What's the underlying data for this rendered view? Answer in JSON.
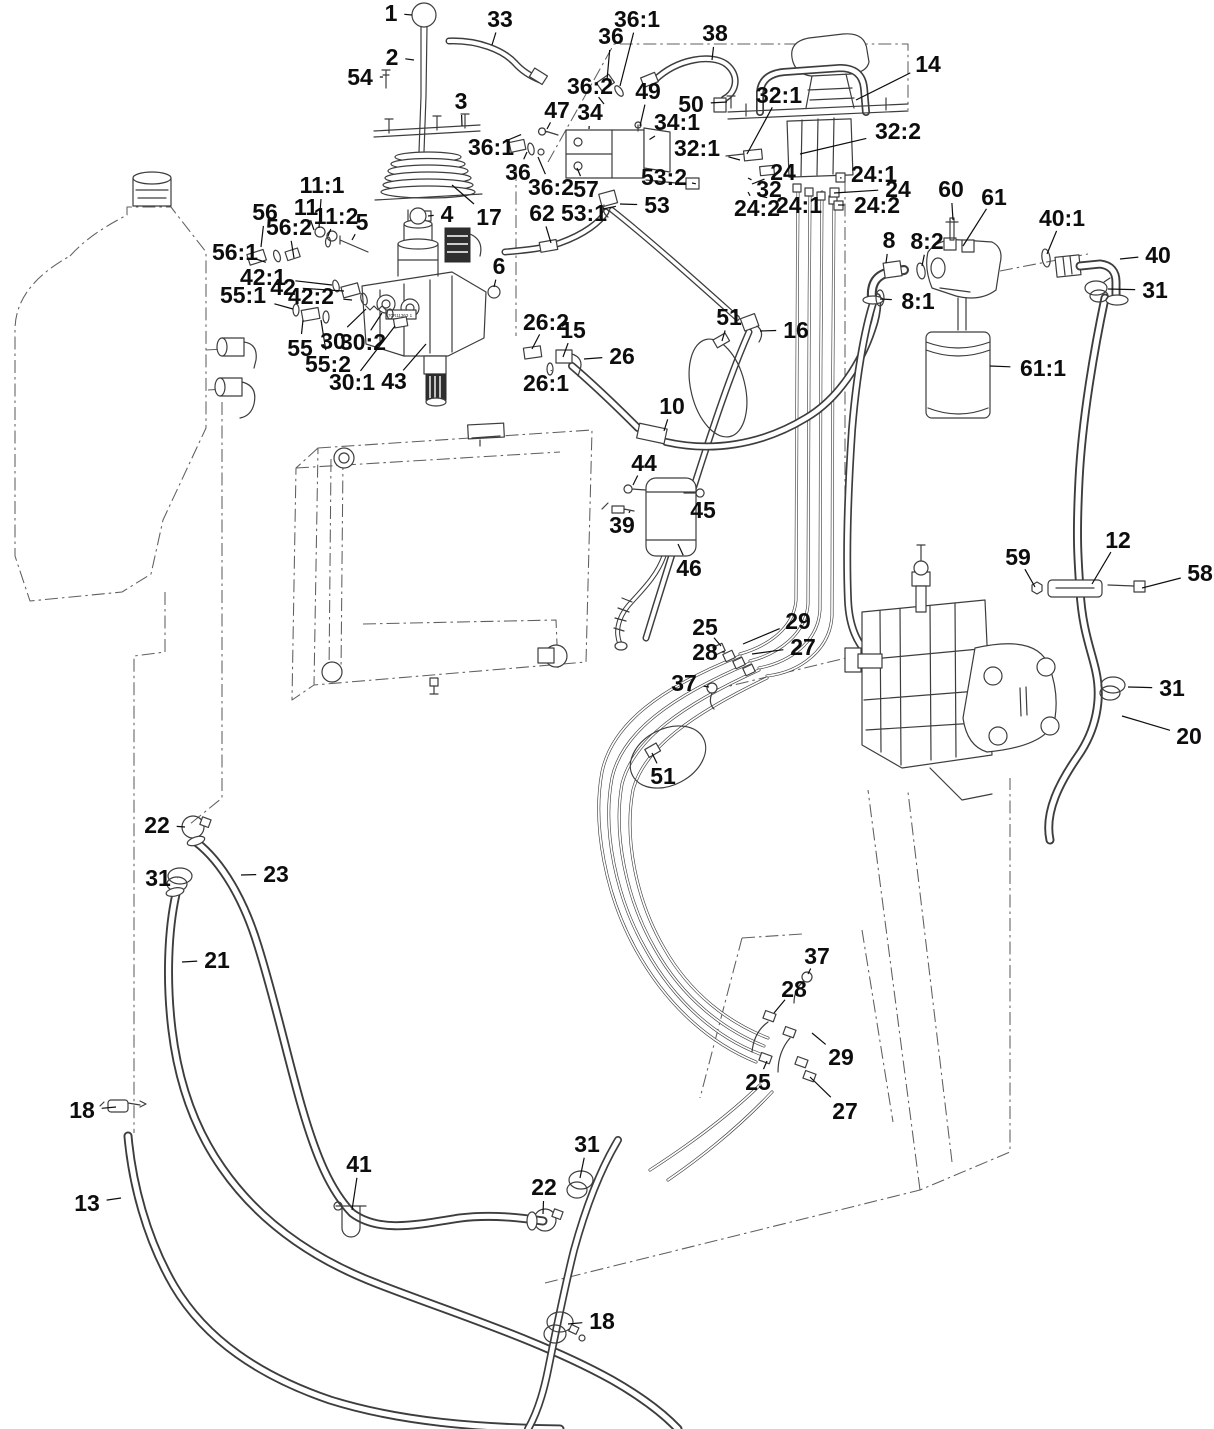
{
  "diagram": {
    "type": "parts-diagram",
    "canvas": {
      "width": 1214,
      "height": 1429
    },
    "colors": {
      "line": "#3d3d3d",
      "label": "#0d0d0d",
      "background": "#ffffff",
      "dash": "#5f5f5f"
    },
    "sticker_text": "70R11363 1",
    "callouts": [
      {
        "id": "1",
        "text": "1",
        "x": 391,
        "y": 13,
        "lx": 412,
        "ly": 15
      },
      {
        "id": "2",
        "text": "2",
        "x": 392,
        "y": 57,
        "lx": 414,
        "ly": 60
      },
      {
        "id": "54",
        "text": "54",
        "x": 360,
        "y": 77,
        "lx": 383,
        "ly": 77
      },
      {
        "id": "33",
        "text": "33",
        "x": 500,
        "y": 19,
        "lx": 492,
        "ly": 45
      },
      {
        "id": "3",
        "text": "3",
        "x": 461,
        "y": 101,
        "lx": 462,
        "ly": 126
      },
      {
        "id": "36-top",
        "text": "36",
        "x": 611,
        "y": 36,
        "lx": 607,
        "ly": 80
      },
      {
        "id": "36-1-top",
        "text": "36:1",
        "x": 637,
        "y": 19,
        "lx": 620,
        "ly": 86
      },
      {
        "id": "38",
        "text": "38",
        "x": 715,
        "y": 33,
        "lx": 712,
        "ly": 60
      },
      {
        "id": "36-2-top",
        "text": "36:2",
        "x": 590,
        "y": 86,
        "lx": 604,
        "ly": 104
      },
      {
        "id": "47",
        "text": "47",
        "x": 557,
        "y": 110,
        "lx": 547,
        "ly": 129
      },
      {
        "id": "34",
        "text": "34",
        "x": 590,
        "y": 112,
        "lx": 589,
        "ly": 129
      },
      {
        "id": "49",
        "text": "49",
        "x": 648,
        "y": 91,
        "lx": 640,
        "ly": 126
      },
      {
        "id": "50",
        "text": "50",
        "x": 691,
        "y": 104,
        "lx": 727,
        "ly": 102
      },
      {
        "id": "34-1",
        "text": "34:1",
        "x": 677,
        "y": 122,
        "lx": 655,
        "ly": 136
      },
      {
        "id": "32-1-top",
        "text": "32:1",
        "x": 779,
        "y": 95,
        "lx": 747,
        "ly": 154
      },
      {
        "id": "32-2",
        "text": "32:2",
        "x": 898,
        "y": 131,
        "lx": 800,
        "ly": 154
      },
      {
        "id": "32-1-mid",
        "text": "32:1",
        "x": 697,
        "y": 148,
        "lx": 740,
        "ly": 160
      },
      {
        "id": "24-l",
        "text": "24",
        "x": 783,
        "y": 172,
        "lx": 752,
        "ly": 184
      },
      {
        "id": "32-l",
        "text": "32",
        "x": 769,
        "y": 189,
        "lx": 748,
        "ly": 178
      },
      {
        "id": "24-2-l",
        "text": "24:2",
        "x": 757,
        "y": 208,
        "lx": 748,
        "ly": 192
      },
      {
        "id": "24-1-l",
        "text": "24:1",
        "x": 799,
        "y": 205,
        "lx": 760,
        "ly": 196
      },
      {
        "id": "24-1-r",
        "text": "24:1",
        "x": 874,
        "y": 174,
        "lx": 840,
        "ly": 178
      },
      {
        "id": "24-r",
        "text": "24",
        "x": 898,
        "y": 189,
        "lx": 834,
        "ly": 193
      },
      {
        "id": "24-2-r",
        "text": "24:2",
        "x": 877,
        "y": 205,
        "lx": 838,
        "ly": 205
      },
      {
        "id": "14",
        "text": "14",
        "x": 928,
        "y": 64,
        "lx": 856,
        "ly": 100
      },
      {
        "id": "53-2",
        "text": "53:2",
        "x": 664,
        "y": 177,
        "lx": 692,
        "ly": 183
      },
      {
        "id": "53",
        "text": "53",
        "x": 657,
        "y": 205,
        "lx": 620,
        "ly": 204
      },
      {
        "id": "53-1",
        "text": "53:1",
        "x": 584,
        "y": 213,
        "lx": 603,
        "ly": 209
      },
      {
        "id": "62",
        "text": "62",
        "x": 542,
        "y": 213,
        "lx": 551,
        "ly": 243
      },
      {
        "id": "57",
        "text": "57",
        "x": 586,
        "y": 189,
        "lx": 577,
        "ly": 168
      },
      {
        "id": "36-2-l",
        "text": "36:2",
        "x": 551,
        "y": 187,
        "lx": 538,
        "ly": 157
      },
      {
        "id": "36-l",
        "text": "36",
        "x": 518,
        "y": 172,
        "lx": 527,
        "ly": 152
      },
      {
        "id": "36-1-l",
        "text": "36:1",
        "x": 491,
        "y": 147,
        "lx": 508,
        "ly": 140
      },
      {
        "id": "17",
        "text": "17",
        "x": 489,
        "y": 217,
        "lx": 452,
        "ly": 185
      },
      {
        "id": "4",
        "text": "4",
        "x": 447,
        "y": 214,
        "lx": 428,
        "ly": 216
      },
      {
        "id": "11-1",
        "text": "11:1",
        "x": 322,
        "y": 185,
        "lx": 319,
        "ly": 228
      },
      {
        "id": "11",
        "text": "11",
        "x": 306,
        "y": 207,
        "lx": 314,
        "ly": 230
      },
      {
        "id": "11-2",
        "text": "11:2",
        "x": 336,
        "y": 216,
        "lx": 328,
        "ly": 236
      },
      {
        "id": "5",
        "text": "5",
        "x": 362,
        "y": 222,
        "lx": 352,
        "ly": 240
      },
      {
        "id": "56",
        "text": "56",
        "x": 265,
        "y": 212,
        "lx": 261,
        "ly": 247
      },
      {
        "id": "56-2",
        "text": "56:2",
        "x": 289,
        "y": 227,
        "lx": 294,
        "ly": 258
      },
      {
        "id": "56-1",
        "text": "56:1",
        "x": 235,
        "y": 252,
        "lx": 256,
        "ly": 259
      },
      {
        "id": "42-1",
        "text": "42:1",
        "x": 263,
        "y": 277,
        "lx": 332,
        "ly": 285
      },
      {
        "id": "42",
        "text": "42",
        "x": 283,
        "y": 287,
        "lx": 344,
        "ly": 291
      },
      {
        "id": "42-2",
        "text": "42:2",
        "x": 311,
        "y": 296,
        "lx": 352,
        "ly": 300
      },
      {
        "id": "55-1",
        "text": "55:1",
        "x": 243,
        "y": 295,
        "lx": 293,
        "ly": 309
      },
      {
        "id": "55",
        "text": "55",
        "x": 300,
        "y": 348,
        "lx": 303,
        "ly": 320
      },
      {
        "id": "55-2",
        "text": "55:2",
        "x": 328,
        "y": 364,
        "lx": 321,
        "ly": 320
      },
      {
        "id": "30",
        "text": "30",
        "x": 333,
        "y": 341,
        "lx": 366,
        "ly": 309
      },
      {
        "id": "30-2",
        "text": "30:2",
        "x": 363,
        "y": 342,
        "lx": 382,
        "ly": 313
      },
      {
        "id": "30-1",
        "text": "30:1",
        "x": 352,
        "y": 382,
        "lx": 395,
        "ly": 326
      },
      {
        "id": "43",
        "text": "43",
        "x": 394,
        "y": 381,
        "lx": 426,
        "ly": 344
      },
      {
        "id": "6",
        "text": "6",
        "x": 499,
        "y": 266,
        "lx": 494,
        "ly": 287
      },
      {
        "id": "26-2",
        "text": "26:2",
        "x": 546,
        "y": 322,
        "lx": 532,
        "ly": 349
      },
      {
        "id": "15",
        "text": "15",
        "x": 573,
        "y": 330,
        "lx": 563,
        "ly": 357
      },
      {
        "id": "26",
        "text": "26",
        "x": 622,
        "y": 356,
        "lx": 584,
        "ly": 359
      },
      {
        "id": "26-1",
        "text": "26:1",
        "x": 546,
        "y": 383,
        "lx": 551,
        "ly": 371
      },
      {
        "id": "51-top",
        "text": "51",
        "x": 729,
        "y": 317,
        "lx": 722,
        "ly": 341
      },
      {
        "id": "16",
        "text": "16",
        "x": 796,
        "y": 330,
        "lx": 760,
        "ly": 331
      },
      {
        "id": "10",
        "text": "10",
        "x": 672,
        "y": 406,
        "lx": 664,
        "ly": 431
      },
      {
        "id": "44",
        "text": "44",
        "x": 644,
        "y": 463,
        "lx": 633,
        "ly": 485
      },
      {
        "id": "45",
        "text": "45",
        "x": 703,
        "y": 510,
        "lx": 702,
        "ly": 496
      },
      {
        "id": "39",
        "text": "39",
        "x": 622,
        "y": 525,
        "lx": 630,
        "ly": 511
      },
      {
        "id": "46",
        "text": "46",
        "x": 689,
        "y": 568,
        "lx": 678,
        "ly": 544
      },
      {
        "id": "8",
        "text": "8",
        "x": 889,
        "y": 240,
        "lx": 886,
        "ly": 263
      },
      {
        "id": "8-2",
        "text": "8:2",
        "x": 927,
        "y": 241,
        "lx": 922,
        "ly": 266
      },
      {
        "id": "60",
        "text": "60",
        "x": 951,
        "y": 189,
        "lx": 953,
        "ly": 220
      },
      {
        "id": "61",
        "text": "61",
        "x": 994,
        "y": 197,
        "lx": 963,
        "ly": 246
      },
      {
        "id": "40-1",
        "text": "40:1",
        "x": 1062,
        "y": 218,
        "lx": 1047,
        "ly": 254
      },
      {
        "id": "40",
        "text": "40",
        "x": 1158,
        "y": 255,
        "lx": 1120,
        "ly": 259
      },
      {
        "id": "31-tr",
        "text": "31",
        "x": 1155,
        "y": 290,
        "lx": 1108,
        "ly": 289
      },
      {
        "id": "8-1",
        "text": "8:1",
        "x": 918,
        "y": 301,
        "lx": 880,
        "ly": 299
      },
      {
        "id": "61-1",
        "text": "61:1",
        "x": 1043,
        "y": 368,
        "lx": 990,
        "ly": 366
      },
      {
        "id": "59",
        "text": "59",
        "x": 1018,
        "y": 557,
        "lx": 1035,
        "ly": 587
      },
      {
        "id": "12",
        "text": "12",
        "x": 1118,
        "y": 540,
        "lx": 1092,
        "ly": 584
      },
      {
        "id": "58",
        "text": "58",
        "x": 1200,
        "y": 573,
        "lx": 1142,
        "ly": 588
      },
      {
        "id": "31-rm",
        "text": "31",
        "x": 1172,
        "y": 688,
        "lx": 1128,
        "ly": 687
      },
      {
        "id": "20",
        "text": "20",
        "x": 1189,
        "y": 736,
        "lx": 1122,
        "ly": 716
      },
      {
        "id": "25-u",
        "text": "25",
        "x": 705,
        "y": 627,
        "lx": 721,
        "ly": 646
      },
      {
        "id": "29-u",
        "text": "29",
        "x": 798,
        "y": 621,
        "lx": 743,
        "ly": 644
      },
      {
        "id": "28-u",
        "text": "28",
        "x": 705,
        "y": 652,
        "lx": 722,
        "ly": 652
      },
      {
        "id": "27-u",
        "text": "27",
        "x": 803,
        "y": 647,
        "lx": 752,
        "ly": 654
      },
      {
        "id": "37-u",
        "text": "37",
        "x": 684,
        "y": 683,
        "lx": 709,
        "ly": 687
      },
      {
        "id": "51-low",
        "text": "51",
        "x": 663,
        "y": 776,
        "lx": 652,
        "ly": 753
      },
      {
        "id": "22-l",
        "text": "22",
        "x": 157,
        "y": 825,
        "lx": 185,
        "ly": 827
      },
      {
        "id": "23",
        "text": "23",
        "x": 276,
        "y": 874,
        "lx": 241,
        "ly": 875
      },
      {
        "id": "31-ll",
        "text": "31",
        "x": 158,
        "y": 878,
        "lx": 178,
        "ly": 878
      },
      {
        "id": "21",
        "text": "21",
        "x": 217,
        "y": 960,
        "lx": 182,
        "ly": 962
      },
      {
        "id": "18-l",
        "text": "18",
        "x": 82,
        "y": 1110,
        "lx": 116,
        "ly": 1107
      },
      {
        "id": "13",
        "text": "13",
        "x": 87,
        "y": 1203,
        "lx": 121,
        "ly": 1198
      },
      {
        "id": "41",
        "text": "41",
        "x": 359,
        "y": 1164,
        "lx": 352,
        "ly": 1210
      },
      {
        "id": "22-b",
        "text": "22",
        "x": 544,
        "y": 1187,
        "lx": 543,
        "ly": 1214
      },
      {
        "id": "31-b",
        "text": "31",
        "x": 587,
        "y": 1144,
        "lx": 580,
        "ly": 1178
      },
      {
        "id": "18-b",
        "text": "18",
        "x": 602,
        "y": 1321,
        "lx": 568,
        "ly": 1324
      },
      {
        "id": "37-l",
        "text": "37",
        "x": 817,
        "y": 956,
        "lx": 808,
        "ly": 974
      },
      {
        "id": "28-l",
        "text": "28",
        "x": 794,
        "y": 989,
        "lx": 774,
        "ly": 1013
      },
      {
        "id": "29-l",
        "text": "29",
        "x": 841,
        "y": 1057,
        "lx": 812,
        "ly": 1033
      },
      {
        "id": "25-l",
        "text": "25",
        "x": 758,
        "y": 1082,
        "lx": 767,
        "ly": 1061
      },
      {
        "id": "27-l",
        "text": "27",
        "x": 845,
        "y": 1111,
        "lx": 810,
        "ly": 1077
      }
    ]
  }
}
